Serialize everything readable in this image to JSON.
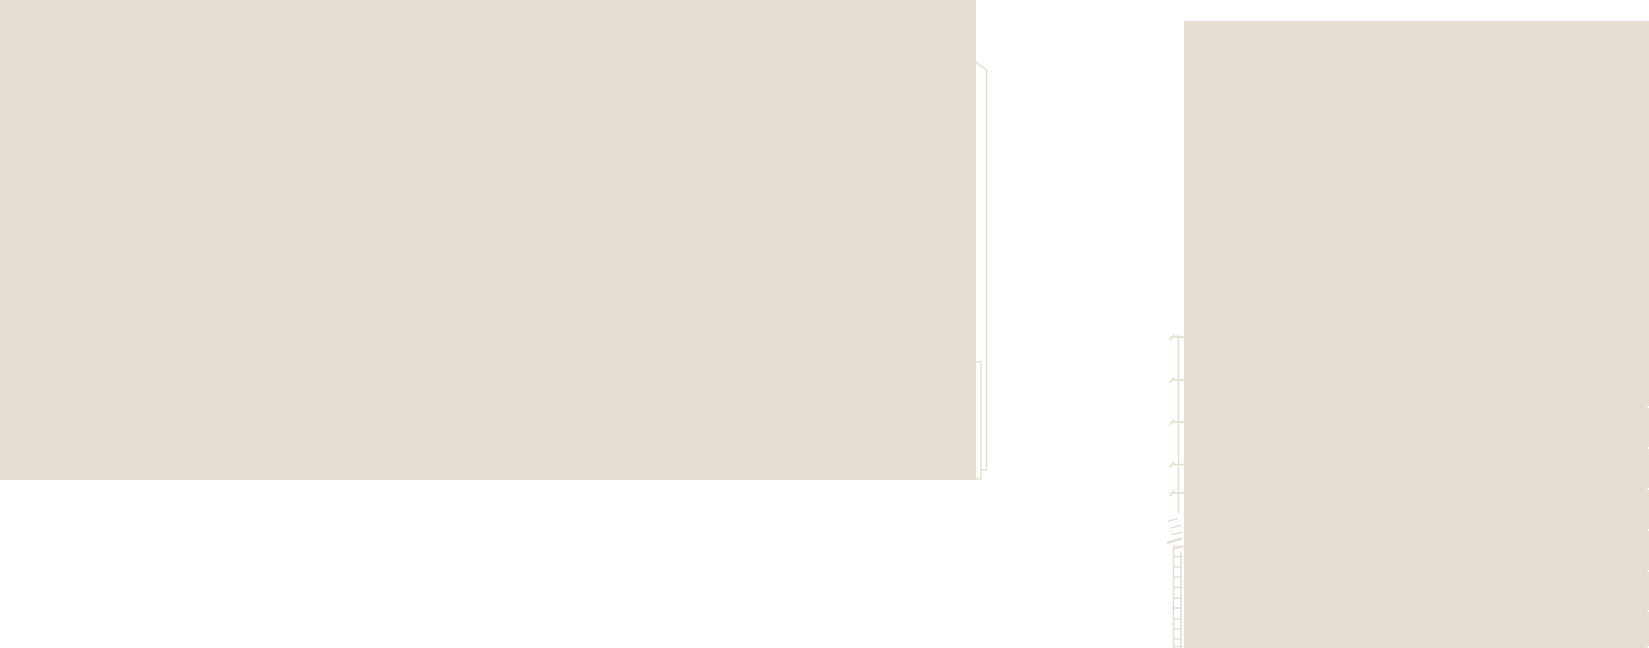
{
  "canvas": {
    "width_px": 1649,
    "height_px": 648
  },
  "colors": {
    "background": "#ffffff",
    "panel_beige": "#e5ded1",
    "line_beige": "#e6dfd3"
  },
  "panels": [
    {
      "id": "left-beige-panel",
      "x": 0,
      "y": 0,
      "w": 976,
      "h": 480
    },
    {
      "id": "right-beige-panel",
      "x": 1184,
      "y": 21,
      "w": 465,
      "h": 627
    }
  ],
  "drawing": {
    "segments": [
      {
        "name": "roof-diagonal-line",
        "x1": 975.5,
        "y1": 62,
        "x2": 986.5,
        "y2": 69.5
      },
      {
        "name": "tall-vertical-line",
        "x1": 986.5,
        "y1": 69.5,
        "x2": 986.5,
        "y2": 470
      },
      {
        "name": "jog-line",
        "x1": 981,
        "y1": 470,
        "x2": 986.5,
        "y2": 470
      },
      {
        "name": "dimension-chain-line",
        "x1": 1178.5,
        "y1": 335,
        "x2": 1178.5,
        "y2": 513.5
      },
      {
        "name": "dimension-tick",
        "x1": 1170.5,
        "y1": 337,
        "x2": 1184.5,
        "y2": 337
      },
      {
        "name": "dimension-tick-serif",
        "x1": 1169.5,
        "y1": 340,
        "x2": 1174.5,
        "y2": 334.5
      },
      {
        "name": "dimension-tick",
        "x1": 1170.5,
        "y1": 380,
        "x2": 1184.5,
        "y2": 380
      },
      {
        "name": "dimension-tick-serif",
        "x1": 1169.5,
        "y1": 383,
        "x2": 1174.5,
        "y2": 377.5
      },
      {
        "name": "dimension-tick",
        "x1": 1170.5,
        "y1": 422,
        "x2": 1184.5,
        "y2": 422
      },
      {
        "name": "dimension-tick-serif",
        "x1": 1169.5,
        "y1": 425,
        "x2": 1174.5,
        "y2": 419.5
      },
      {
        "name": "dimension-tick",
        "x1": 1170.5,
        "y1": 464.5,
        "x2": 1184.5,
        "y2": 464.5
      },
      {
        "name": "dimension-tick-serif",
        "x1": 1169.5,
        "y1": 467.5,
        "x2": 1174.5,
        "y2": 462
      },
      {
        "name": "dimension-tick",
        "x1": 1170.5,
        "y1": 493,
        "x2": 1185.5,
        "y2": 493
      },
      {
        "name": "dimension-tick-serif",
        "x1": 1169.5,
        "y1": 496,
        "x2": 1174.5,
        "y2": 490.5
      },
      {
        "name": "break-mark",
        "x1": 1168,
        "y1": 521,
        "x2": 1178,
        "y2": 518.5
      },
      {
        "name": "break-mark",
        "x1": 1170,
        "y1": 528,
        "x2": 1181,
        "y2": 525.5
      },
      {
        "name": "break-mark",
        "x1": 1172,
        "y1": 534.5,
        "x2": 1183,
        "y2": 532
      },
      {
        "name": "break-mark",
        "x1": 1167,
        "y1": 543,
        "x2": 1182,
        "y2": 538.5,
        "w": 2.6
      },
      {
        "name": "break-mark",
        "x1": 1174,
        "y1": 549,
        "x2": 1185,
        "y2": 546
      },
      {
        "name": "ladder-rail-left",
        "x1": 1173.5,
        "y1": 546,
        "x2": 1173.5,
        "y2": 648
      },
      {
        "name": "ladder-rail-right",
        "x1": 1181,
        "y1": 551,
        "x2": 1181,
        "y2": 648
      },
      {
        "name": "ladder-rung",
        "x1": 1173,
        "y1": 546.5,
        "x2": 1182,
        "y2": 546.5
      },
      {
        "name": "ladder-rung",
        "x1": 1173,
        "y1": 556.5,
        "x2": 1182,
        "y2": 556.5
      },
      {
        "name": "ladder-rung",
        "x1": 1173,
        "y1": 567,
        "x2": 1182,
        "y2": 567
      },
      {
        "name": "ladder-rung",
        "x1": 1173,
        "y1": 577,
        "x2": 1182,
        "y2": 577
      },
      {
        "name": "ladder-rung",
        "x1": 1173,
        "y1": 587.5,
        "x2": 1182,
        "y2": 587.5
      },
      {
        "name": "ladder-rung",
        "x1": 1173,
        "y1": 598,
        "x2": 1182,
        "y2": 598
      },
      {
        "name": "ladder-rung",
        "x1": 1173,
        "y1": 608,
        "x2": 1182,
        "y2": 608
      },
      {
        "name": "ladder-rung",
        "x1": 1173,
        "y1": 619,
        "x2": 1182,
        "y2": 619
      },
      {
        "name": "ladder-rung",
        "x1": 1173,
        "y1": 629,
        "x2": 1182,
        "y2": 629
      },
      {
        "name": "ladder-rung",
        "x1": 1173,
        "y1": 639,
        "x2": 1182,
        "y2": 639
      },
      {
        "name": "ladder-rung",
        "x1": 1173,
        "y1": 646.5,
        "x2": 1182,
        "y2": 646.5
      }
    ],
    "outline_rects": [
      {
        "name": "narrow-box-outline",
        "x": 975.5,
        "y": 362,
        "w": 5.5,
        "h": 117
      }
    ],
    "edge_notches": {
      "x": 1647.5,
      "w": 1.5,
      "h": 2,
      "ys": [
        406,
        447,
        488,
        529,
        570,
        610,
        646
      ]
    }
  }
}
